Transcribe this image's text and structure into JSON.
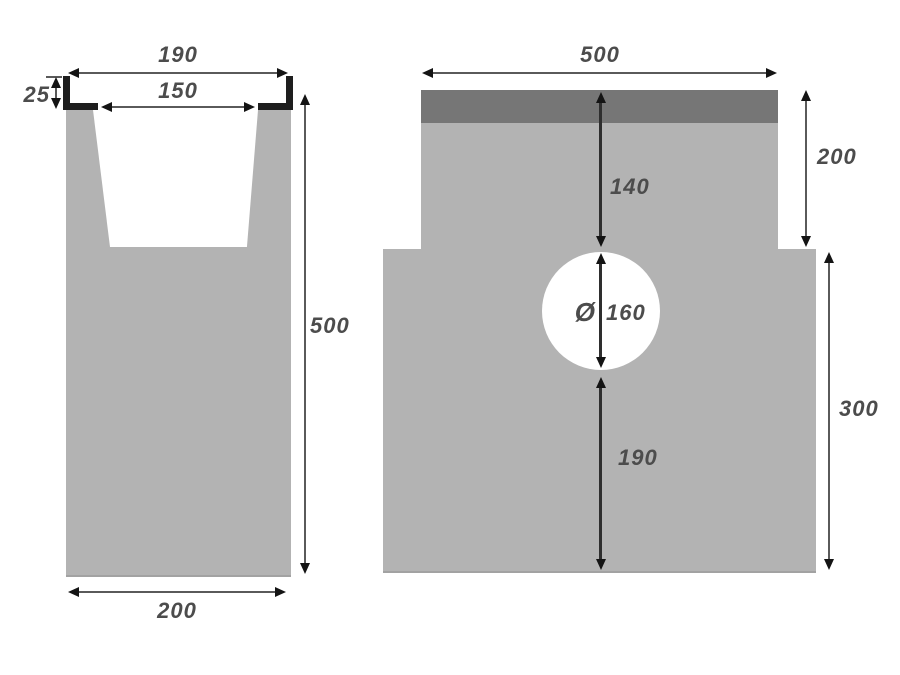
{
  "diagram": {
    "background": "#ffffff",
    "body_color": "#b3b3b3",
    "grate_color": "#767676",
    "edge_rail_color": "#1e1e1e",
    "dimension_line_color": "#5a5a5a",
    "label_color": "#4c4c4c"
  },
  "left_view": {
    "name": "channel cross-section",
    "top_width": "190",
    "inner_width": "150",
    "edge_depth": "25",
    "overall_height": "500",
    "bottom_width": "200"
  },
  "right_view": {
    "name": "channel front elevation",
    "overall_width": "500",
    "upper_section_height": "200",
    "top_to_outlet": "140",
    "diameter_symbol": "Ø",
    "outlet_diameter": "160",
    "outlet_to_bottom": "190",
    "lower_section_height": "300"
  }
}
